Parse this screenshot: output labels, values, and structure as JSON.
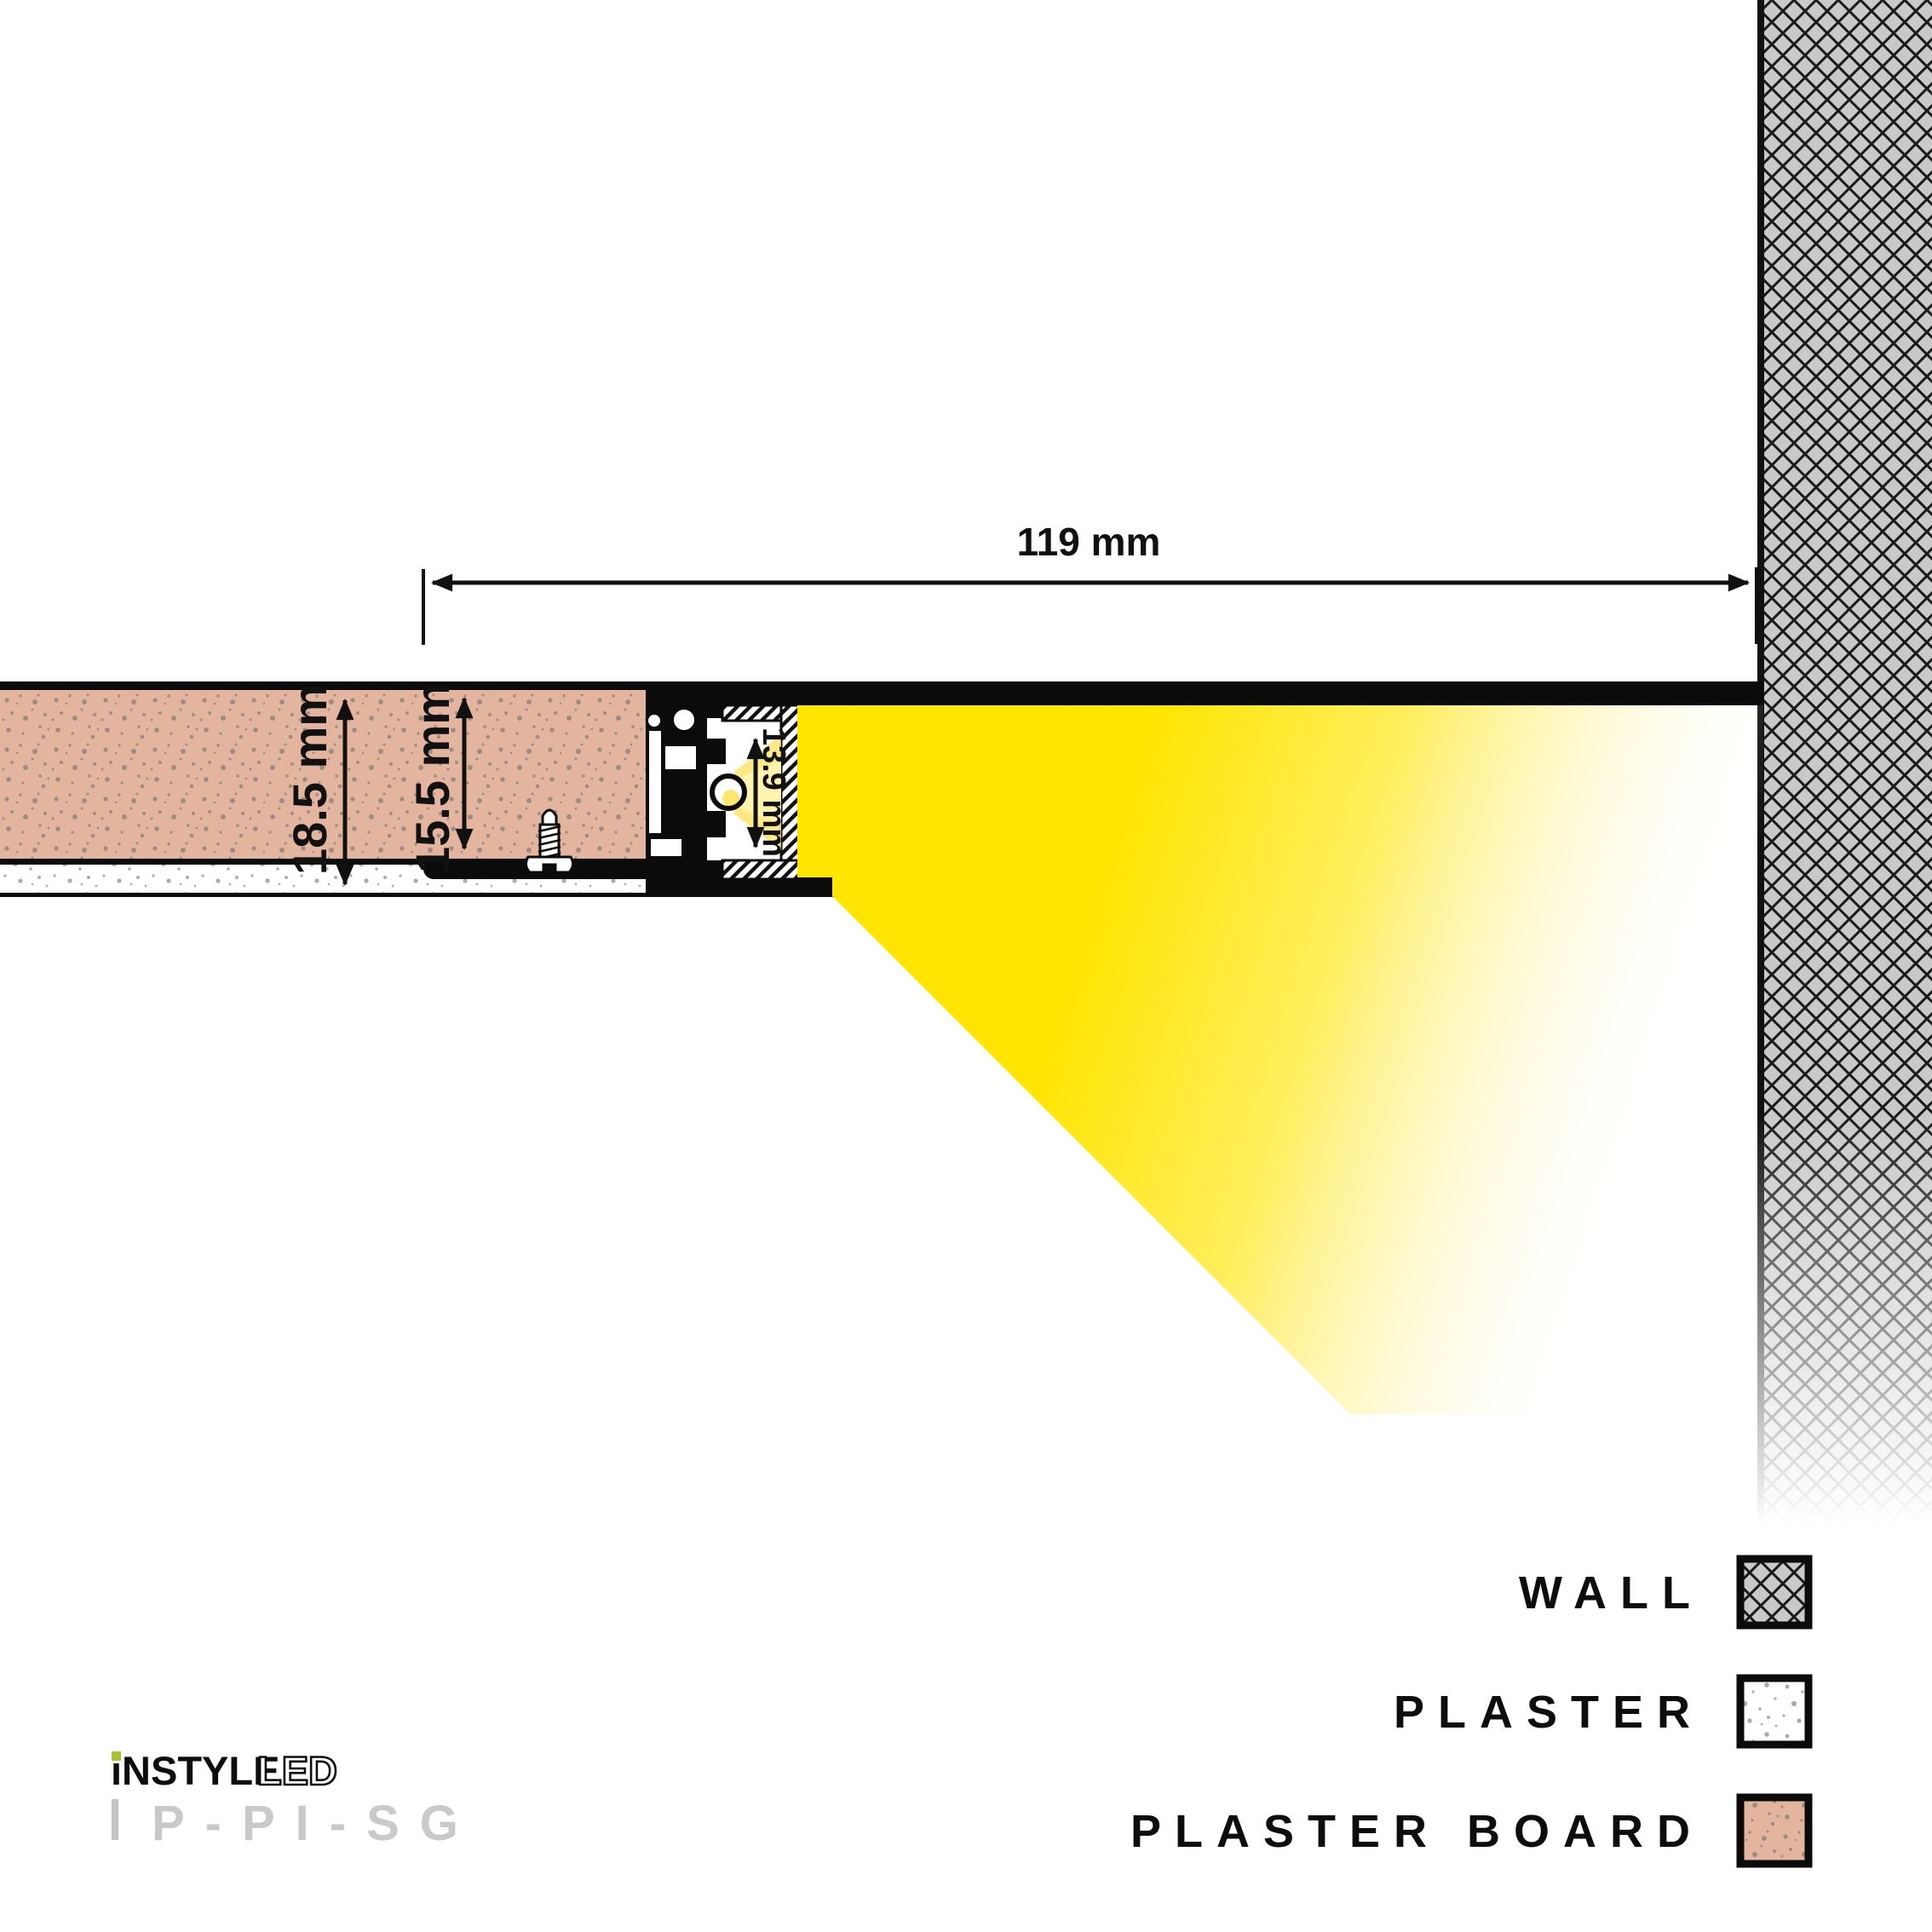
{
  "dimensions": {
    "opening_width": "119 mm",
    "total_depth": "18.5 mm",
    "board_depth": "15.5 mm",
    "channel_height": "13.9 mm"
  },
  "legend": {
    "items": [
      {
        "label": "WALL",
        "swatch": "diamond-hatch"
      },
      {
        "label": "PLASTER",
        "swatch": "white-speckle"
      },
      {
        "label": "PLASTER BOARD",
        "swatch": "pink-speckle"
      }
    ]
  },
  "branding": {
    "brand": "iNSTYLE",
    "brand_suffix": "LED",
    "product_code": "P-PI-SG"
  },
  "colors": {
    "beam_yellow": "#FFE500",
    "plasterboard_pink": "#E3B59E",
    "wall_gray": "#C9C9C9",
    "brand_accent_green": "#A6C32F",
    "product_code_gray": "#C9C9C9"
  }
}
